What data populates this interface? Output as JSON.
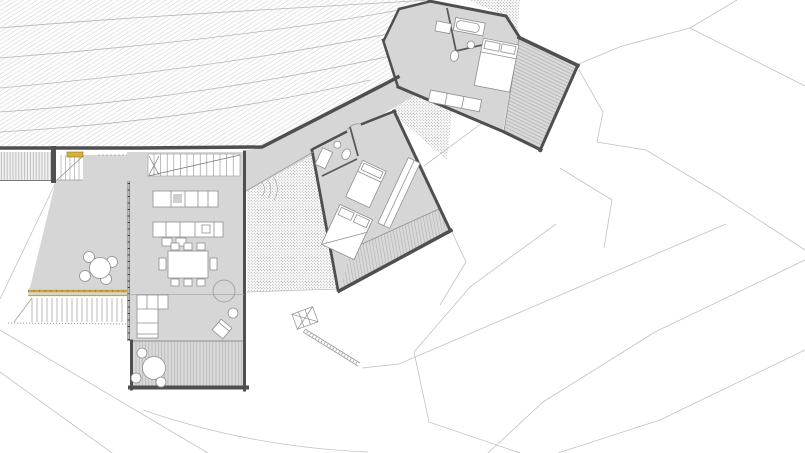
{
  "meta": {
    "type": "architectural-floor-plan",
    "description": "Ground floor plan of a hillside house with three splayed wings stepped along a dark retaining wall, timber decks, gravel patios and terraced terrain",
    "visible_text": []
  },
  "colors": {
    "background": "#ffffff",
    "building_fill": "#d6d6d6",
    "deck_fill": "#d9d9d9",
    "deck_stripe": "#aeaeae",
    "wall_dark": "#4f4f4f",
    "furniture_stroke": "#8f8f8f",
    "furniture_fill": "#ffffff",
    "hatch_line": "#cdcdcd",
    "contour_line": "#c2c2c2",
    "patio_dot": "#9c9c9c",
    "retaining_band_fill": "#f0f0f0",
    "railing_yellow": "#c9a43c",
    "bench_yellow": "#d8b13c"
  },
  "site": {
    "hillside": "hatched uphill slope with contour curves (upper left)",
    "terrain": "open downhill slope with polygonal contour lines (right and bottom)",
    "retaining_wall": "dark retaining wall along the uphill edge of the house"
  },
  "building": {
    "wings": [
      {
        "name": "living-wing",
        "rooms": [
          "kitchen",
          "dining area",
          "living area"
        ],
        "furniture": {
          "kitchen_counters": 2,
          "island_stools": 2,
          "dining_table_seats": 8,
          "sofa": "L-shaped",
          "lounge_chair": 1,
          "round_rug": 1,
          "internal_stair": "along retaining wall"
        },
        "deck": {
          "position": "south",
          "round_table_seats": 3
        }
      },
      {
        "name": "middle-bedroom-wing",
        "rooms": [
          "bedroom 1",
          "bedroom 2",
          "bathroom"
        ],
        "beds": 2,
        "wardrobe": 1,
        "deck": {
          "position": "south-east"
        }
      },
      {
        "name": "upper-bedroom-wing",
        "rooms": [
          "master bedroom",
          "bathroom"
        ],
        "beds": 1,
        "bathtub": 1,
        "wardrobe": 1,
        "deck": {
          "position": "east"
        }
      }
    ],
    "west_terrace": {
      "round_table_seats": 4,
      "railing": "yellow guard rail above wide exterior stair",
      "bench": "small yellow bench at retaining wall"
    },
    "patios": [
      "gravel patio between living and middle wings",
      "gravel patio between middle and upper wings",
      "gravel patch north of upper wing"
    ],
    "exterior_stairs": [
      "wide stair below west terrace",
      "small stair with ramp below middle patio"
    ]
  }
}
